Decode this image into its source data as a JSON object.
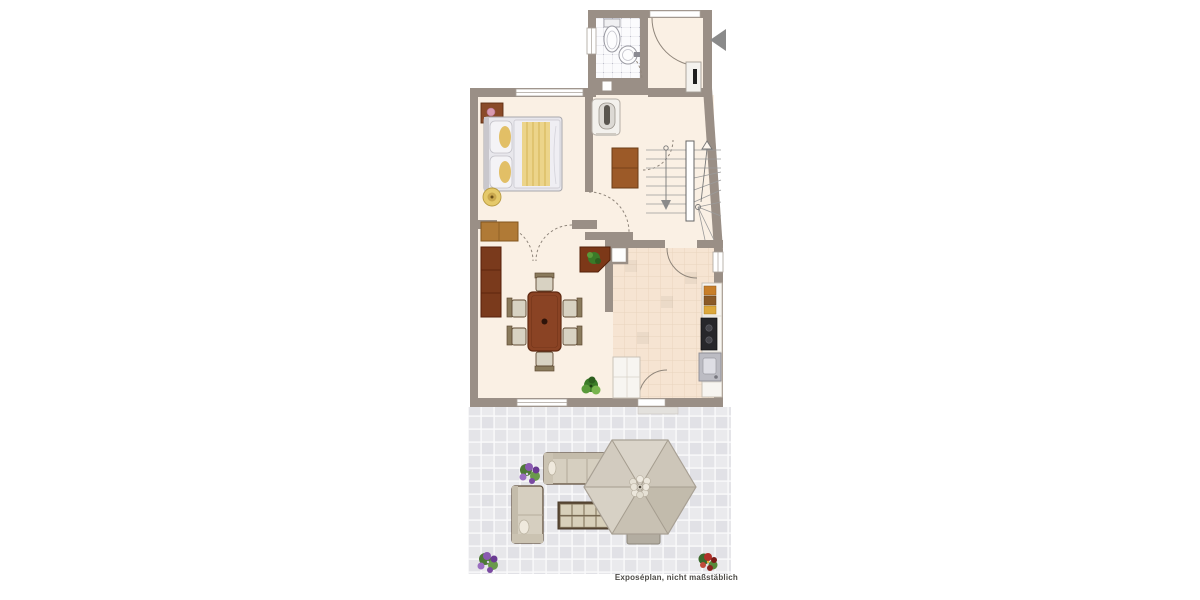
{
  "caption": "Exposéplan, nicht maßstäblich",
  "floor_plan": {
    "kind": "floor-plan-with-terrace",
    "areas": [
      "bathroom",
      "entry-hall",
      "bedroom",
      "hallway",
      "staircase",
      "living-dining-room",
      "kitchen",
      "terrace"
    ],
    "furniture": [
      "toilet",
      "washbasin",
      "double-bed",
      "nightstand",
      "wardrobe",
      "sideboard",
      "tall-cabinet",
      "corner-cabinet",
      "dining-table",
      "dining-chairs",
      "potted-plant",
      "hall-cabinet",
      "water-heater",
      "fridge",
      "kitchen-counter",
      "stove",
      "kitchen-sink",
      "outdoor-sofa",
      "outdoor-coffee-table",
      "parasol",
      "lounger",
      "flower-pots"
    ]
  },
  "colors": {
    "background": "#ffffff",
    "wall": "#9a8f86",
    "floor_cream": "#faf0e4",
    "kitchen_tile": "#f6e4d2",
    "bath_tile": "#fbfbfd",
    "terrace_tile": "#e7e7ea",
    "wood_dark": "#7c3a1e",
    "wood_medium": "#a9742e",
    "dining_wood": "#8a4324",
    "fabric_beige": "#d8d2c2",
    "umbrella_beige": "#d2cbbf",
    "plant_green": "#4e8a34",
    "arrow_gray": "#8a8a8a",
    "caption_text": "#4d4b47"
  }
}
